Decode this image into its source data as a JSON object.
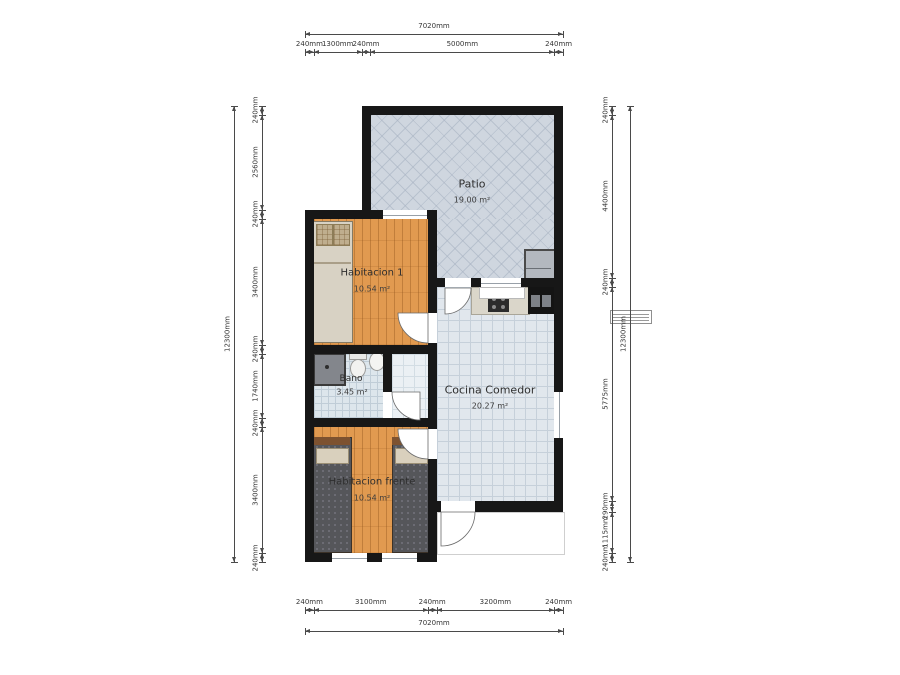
{
  "title": "Floor plan",
  "rooms": [
    {
      "name": "Patio",
      "area": "19.00 m²"
    },
    {
      "name": "Habitacion 1",
      "area": "10.54 m²"
    },
    {
      "name": "Bano",
      "area": "3.45 m²"
    },
    {
      "name": "Cocina Comedor",
      "area": "20.27 m²"
    },
    {
      "name": "Habitacion frente",
      "area": "10.54 m²"
    }
  ],
  "dimensions": {
    "top": {
      "total": "7020mm",
      "segments": [
        "240mm",
        "1300mm",
        "240mm",
        "5000mm",
        "240mm"
      ]
    },
    "bottom": {
      "total": "7020mm",
      "segments": [
        "240mm",
        "3100mm",
        "240mm",
        "3200mm",
        "240mm"
      ]
    },
    "left": {
      "total": "12300mm",
      "segments": [
        "240mm",
        "2560mm",
        "240mm",
        "3400mm",
        "240mm",
        "1740mm",
        "240mm",
        "3400mm",
        "240mm"
      ]
    },
    "right": {
      "total": "12300mm",
      "segments": [
        "240mm",
        "4400mm",
        "240mm",
        "5775mm",
        "290mm",
        "1115mm",
        "240mm"
      ]
    }
  },
  "colors": {
    "wall": "#171717",
    "wood_floor": "#e19a50",
    "kitchen_tile": "#e1e7ed",
    "patio_tile": "#cfd6df",
    "dimension_line": "#4a4a4a"
  }
}
